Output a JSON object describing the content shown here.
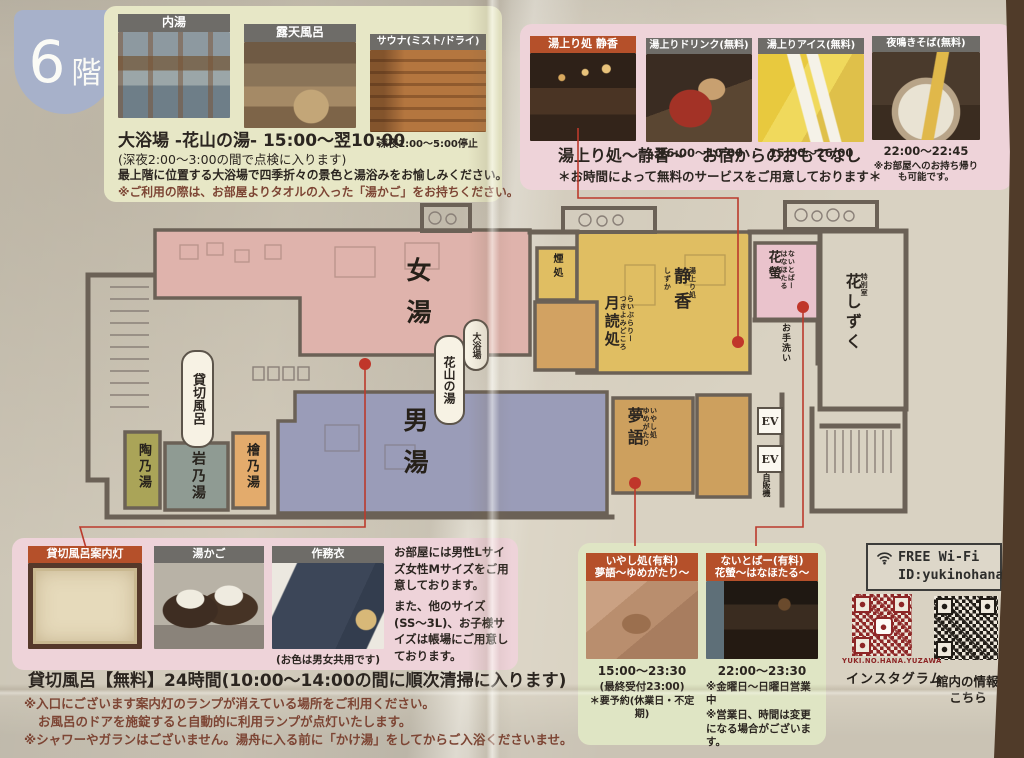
{
  "floor_badge": {
    "number": "6",
    "suffix": "階"
  },
  "daiyokujo": {
    "photo1_label": "内湯",
    "photo2_label": "露天風呂",
    "photo3_label": "サウナ(ミスト/ドライ)",
    "sauna_note": "深夜1:00〜5:00停止",
    "title": "大浴場 -花山の湯- 15:00〜翌10:00",
    "subtitle": "(深夜2:00〜3:00の間で点検に入ります)",
    "desc": "最上階に位置する大浴場で四季折々の景色と湯浴みをお愉しみください。",
    "note": "※ご利用の際は、お部屋よりタオルの入った「湯かご」をお持ちください。"
  },
  "yuagari": {
    "card1_label": "湯上り処 静香",
    "card2_label": "湯上りドリンク(無料)",
    "card2_time": "翌6:00〜10:00",
    "card3_label": "湯上りアイス(無料)",
    "card3_time": "15:00〜26:00",
    "card4_label": "夜鳴きそば(無料)",
    "card4_time": "22:00〜22:45",
    "card4_note": "※お部屋へのお持ち帰りも可能です。",
    "title": "湯上り処〜静香〜　お宿からのおもてなし",
    "subtitle": "＊お時間によって無料のサービスをご用意しております＊"
  },
  "map": {
    "onna_yu": "女湯",
    "otoko_yu": "男湯",
    "daiyokujo_tag": "大浴場",
    "kazan_no_yu": "花山の湯",
    "kashikiri_buro": "貸切風呂",
    "tou_no_yu": "陶乃湯",
    "iwa_no_yu": "岩乃湯",
    "hinoki_no_yu": "檜乃湯",
    "kemuri_dokoro": "煙処",
    "tsukiyomi": {
      "furigana1": "らいぶらりー",
      "furigana2": "つきよみどころ",
      "name": "月読処"
    },
    "shizuka": {
      "furigana1": "湯上り処",
      "name": "静香",
      "furigana2": "しずか"
    },
    "hanahotaru": {
      "furigana1": "ないとばー",
      "furigana2": "はなほたる",
      "name": "花螢"
    },
    "otearai": "お手洗い",
    "hanashizuku": {
      "furigana": "特別室",
      "name": "花しずく"
    },
    "yumegatari": {
      "furigana1": "いやし処",
      "furigana2": "ゆめがたり",
      "name": "夢語"
    },
    "ev1": "EV",
    "ev2": "EV",
    "jihanki": "自販機"
  },
  "amenity": {
    "card1_label": "貸切風呂案内灯",
    "card2_label": "湯かご",
    "card3_label": "作務衣",
    "samue_note": "(お色は男女共用です)",
    "size_note1": "お部屋には男性Lサイズ女性Mサイズをご用意しております。",
    "size_note2": "また、他のサイズ(SS〜3L)、お子様サイズは帳場にご用意しております。"
  },
  "kashikiri_info": {
    "title": "貸切風呂【無料】24時間(10:00〜14:00の間に順次清掃に入ります)",
    "line1": "※入口にございます案内灯のランプが消えている場所をご利用ください。",
    "line2": "お風呂のドアを施錠すると自動的に利用ランプが点灯いたします。",
    "line3": "※シャワーやガランはございません。湯舟に入る前に「かけ湯」をしてからご入浴くださいませ。"
  },
  "paid": {
    "card1": {
      "label1": "いやし処(有料)",
      "label2": "夢語〜ゆめがたり〜",
      "time": "15:00〜23:30",
      "note1": "(最終受付23:00)",
      "note2": "＊要予約(休業日・不定期)"
    },
    "card2": {
      "label1": "ないとばー(有料)",
      "label2": "花螢〜はなほたる〜",
      "time": "22:00〜23:30",
      "note1": "※金曜日〜日曜日営業中",
      "note2": "※営業日、時間は変更になる場合がございます。"
    }
  },
  "wifi": {
    "line1": "FREE Wi-Fi",
    "line2": "ID:yukinohana"
  },
  "qr": {
    "instagram_handle": "YUKI.NO.HANA.YUZAWA",
    "instagram_label": "インスタグラム",
    "info_label": "館内の情報",
    "info_label2": "こちら"
  },
  "colors": {
    "accent_orange": "#b5502a",
    "line_red": "#bb3a2c",
    "badge_blue": "#a7b1ca"
  }
}
